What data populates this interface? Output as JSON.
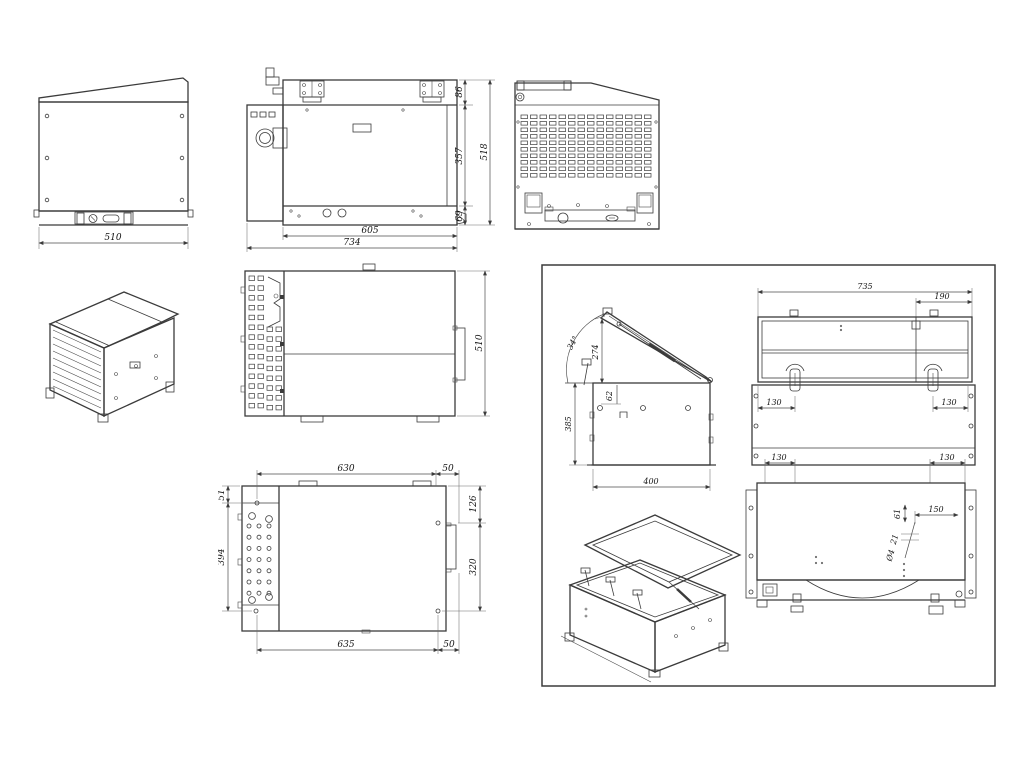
{
  "meta": {
    "sheet": "multi-view technical drawing of generator enclosure box",
    "background": "#ffffff",
    "line_color": "#3b3b3b",
    "dim_color": "#141414"
  },
  "views": {
    "front": {
      "dims": {
        "width": "510"
      }
    },
    "side": {
      "dims": {
        "lid": "86",
        "body": "357",
        "total": "518",
        "base": "69",
        "inner_width": "605",
        "width": "734"
      }
    },
    "top": {
      "dims": {
        "depth": "510"
      }
    },
    "bottom": {
      "dims": {
        "edge": "51",
        "top_span": "630",
        "top_side": "50",
        "right_upper": "126",
        "right_lower": "320",
        "left_span": "394",
        "bottom_span": "635",
        "bottom_side": "50"
      }
    },
    "panel": {
      "open_side": {
        "dims": {
          "angle": "34°",
          "rise": "274",
          "inset": "62",
          "height": "385",
          "width": "400"
        }
      },
      "open_front": {
        "dims": {
          "width": "735",
          "strut": "190",
          "latch_left": "130",
          "latch_right": "130"
        }
      },
      "open_plan": {
        "dims": {
          "latch_left": "130",
          "latch_right": "130",
          "detail_w": "150",
          "detail_h": "61",
          "pitch": "21",
          "hole": "Ø4"
        }
      }
    }
  }
}
